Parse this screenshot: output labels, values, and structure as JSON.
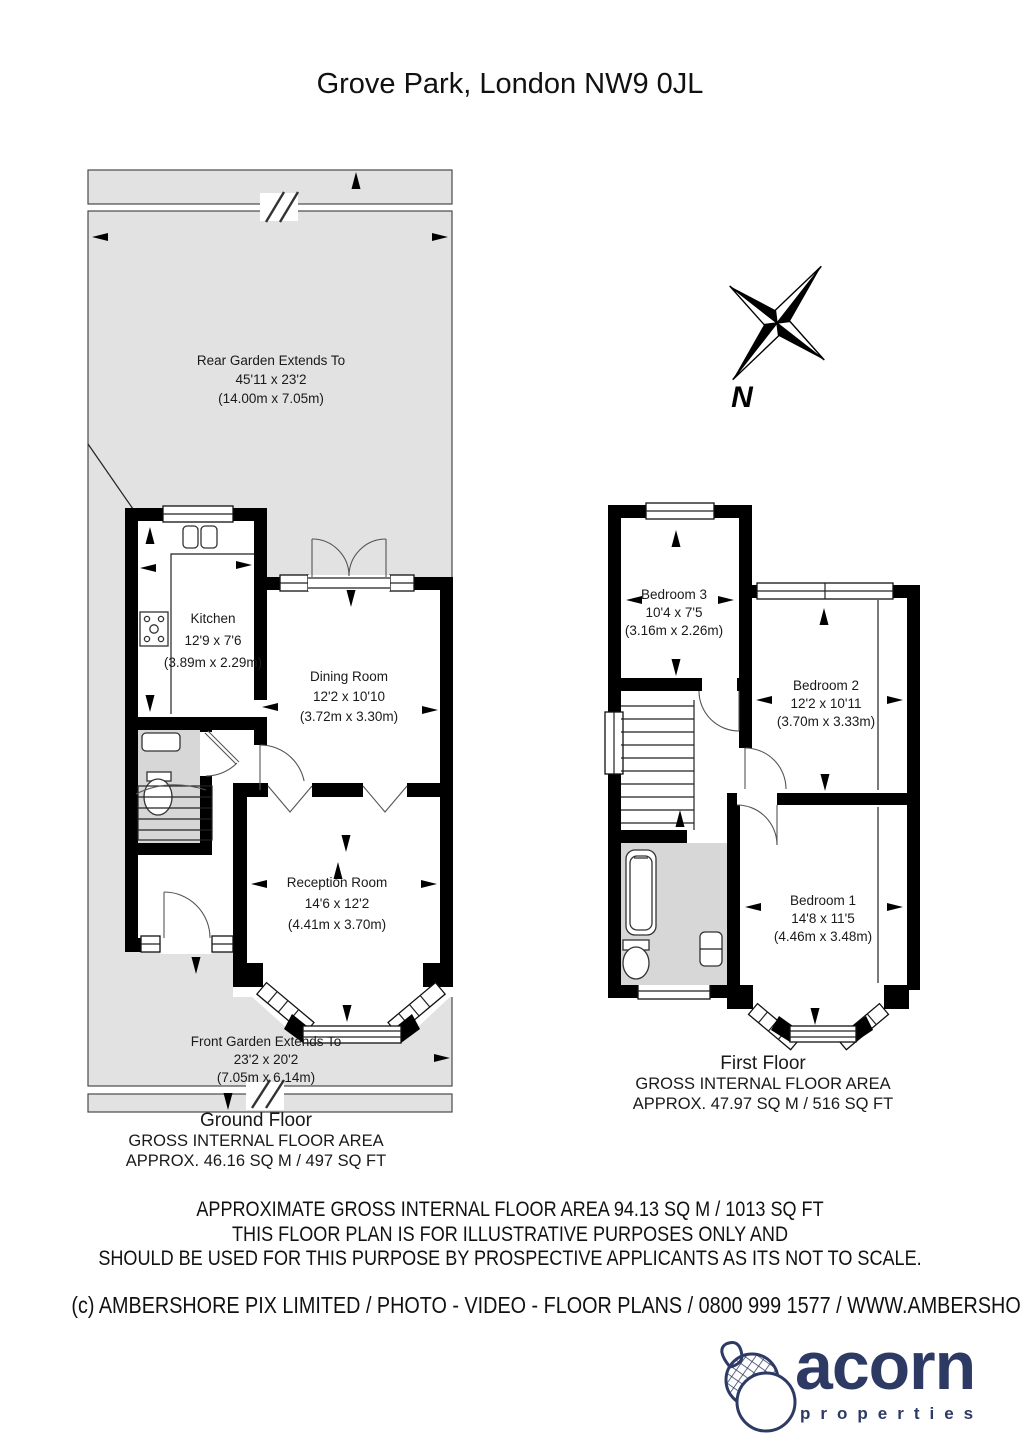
{
  "page": {
    "title": "Grove Park, London NW9 0JL"
  },
  "compass": {
    "north_label": "N"
  },
  "ground_floor": {
    "rear_garden": {
      "line1": "Rear Garden Extends To",
      "line2": "45'11 x 23'2",
      "line3": "(14.00m x 7.05m)"
    },
    "kitchen": {
      "name": "Kitchen",
      "size_imperial": "12'9 x 7'6",
      "size_metric": "(3.89m x 2.29m)"
    },
    "dining_room": {
      "name": "Dining Room",
      "size_imperial": "12'2 x 10'10",
      "size_metric": "(3.72m x 3.30m)"
    },
    "reception_room": {
      "name": "Reception Room",
      "size_imperial": "14'6 x 12'2",
      "size_metric": "(4.41m x 3.70m)"
    },
    "front_garden": {
      "line1": "Front Garden Extends To",
      "line2": "23'2 x 20'2",
      "line3": "(7.05m x 6.14m)"
    },
    "caption": {
      "floor_name": "Ground Floor",
      "area_label": "GROSS INTERNAL FLOOR AREA",
      "area_value": "APPROX. 46.16 SQ M / 497 SQ FT"
    }
  },
  "first_floor": {
    "bedroom_3": {
      "name": "Bedroom 3",
      "size_imperial": "10'4 x 7'5",
      "size_metric": "(3.16m x 2.26m)"
    },
    "bedroom_2": {
      "name": "Bedroom 2",
      "size_imperial": "12'2 x 10'11",
      "size_metric": "(3.70m x 3.33m)"
    },
    "bedroom_1": {
      "name": "Bedroom 1",
      "size_imperial": "14'8 x 11'5",
      "size_metric": "(4.46m x 3.48m)"
    },
    "caption": {
      "floor_name": "First Floor",
      "area_label": "GROSS INTERNAL FLOOR AREA",
      "area_value": "APPROX. 47.97 SQ M / 516 SQ FT"
    }
  },
  "footer": {
    "disclaimer_line1": "APPROXIMATE GROSS INTERNAL FLOOR AREA 94.13 SQ M / 1013 SQ FT",
    "disclaimer_line2": "THIS FLOOR PLAN IS FOR ILLUSTRATIVE PURPOSES ONLY AND",
    "disclaimer_line3": "SHOULD BE USED FOR THIS PURPOSE BY PROSPECTIVE APPLICANTS AS ITS NOT TO SCALE.",
    "copyright": "(c) AMBERSHORE PIX LIMITED / PHOTO - VIDEO - FLOOR PLANS / 0800 999 1577 / WWW.AMBERSHOREPIX.CO.UK"
  },
  "logo": {
    "brand": "acorn",
    "tagline": "properties",
    "brand_color": "#2d3a64"
  },
  "colors": {
    "garden_fill": "#e2e2e2",
    "wet_room_fill": "#d7d7d7",
    "wall": "#000000"
  }
}
